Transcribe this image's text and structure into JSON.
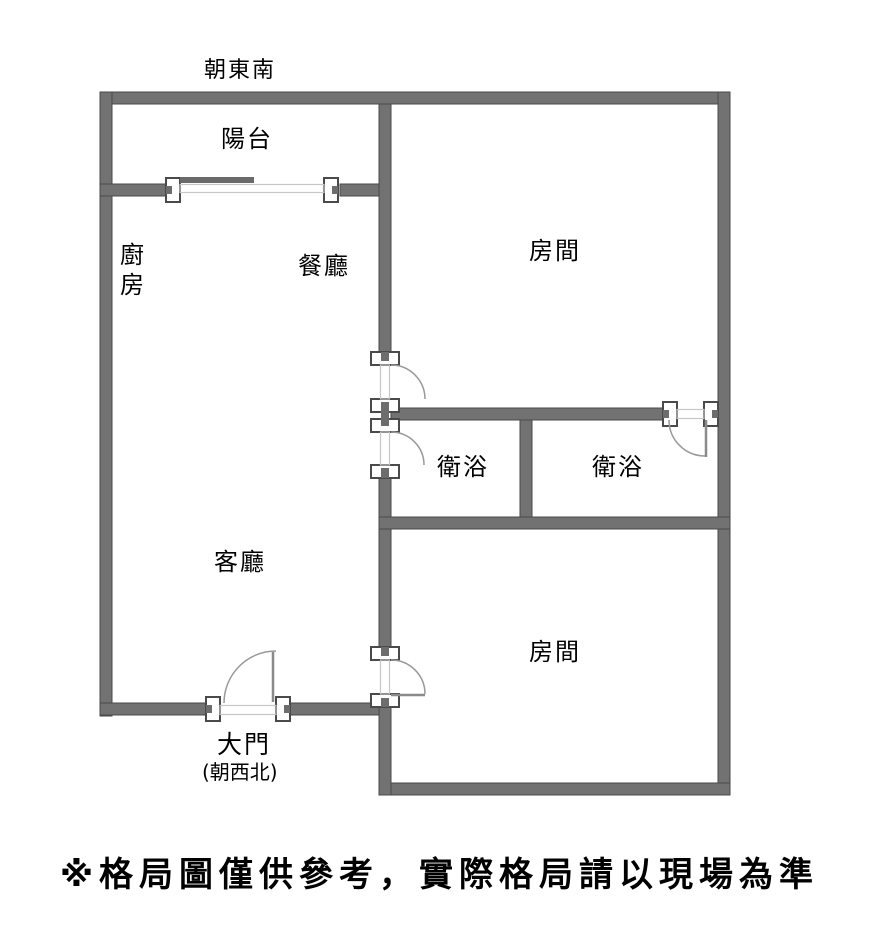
{
  "plan": {
    "facing_top": "朝東南",
    "rooms": {
      "balcony": "陽台",
      "kitchen": "廚房",
      "dining": "餐廳",
      "bedroom_top": "房間",
      "bathroom_left": "衛浴",
      "bathroom_right": "衛浴",
      "living": "客廳",
      "bedroom_bottom": "房間"
    },
    "main_door": {
      "label": "大門",
      "facing": "(朝西北)"
    }
  },
  "disclaimer": "※格局圖僅供參考，實際格局請以現場為準",
  "colors": {
    "wall": "#727272",
    "wall_edge": "#4a4a4a",
    "door_frame": "#c6c6c6",
    "door_arc": "#999999",
    "text": "#000000",
    "background": "#ffffff"
  }
}
